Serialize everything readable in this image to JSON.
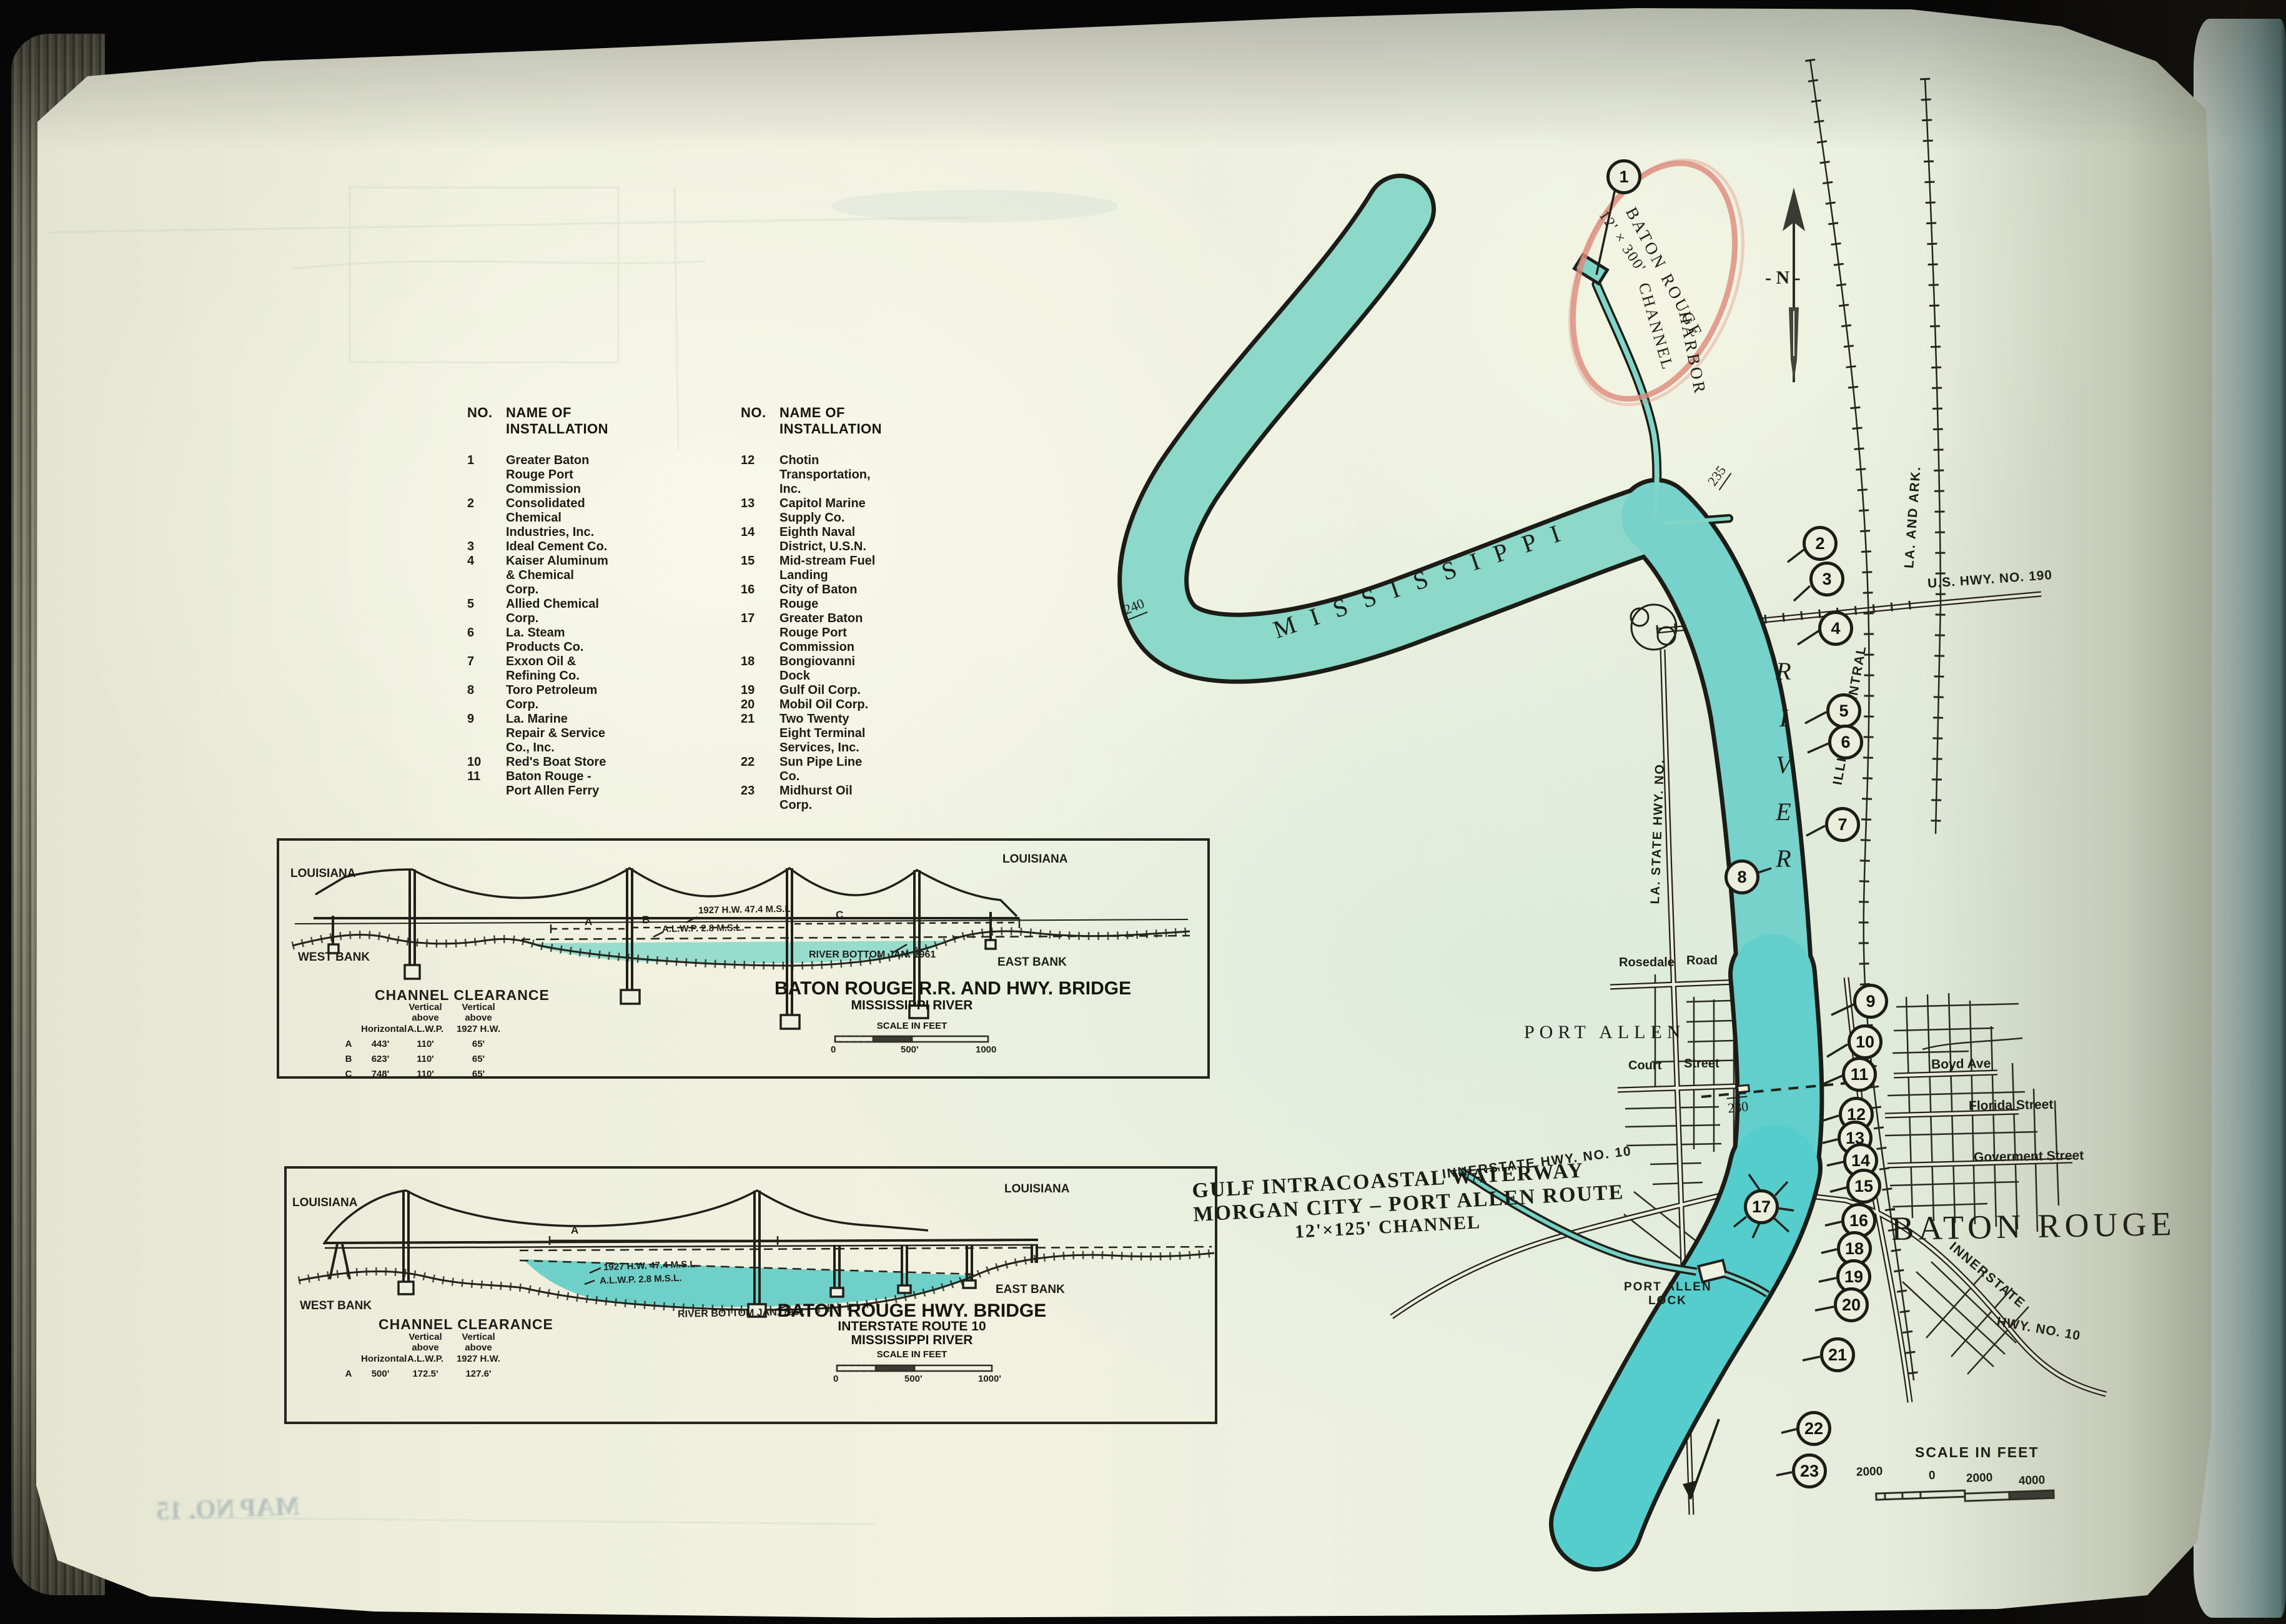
{
  "list": {
    "h_no": "NO.",
    "h_name": "NAME OF INSTALLATION",
    "items": [
      {
        "no": "1",
        "name": "Greater Baton Rouge Port Commission"
      },
      {
        "no": "2",
        "name": "Consolidated Chemical Industries, Inc."
      },
      {
        "no": "3",
        "name": "Ideal Cement Co."
      },
      {
        "no": "4",
        "name": "Kaiser Aluminum & Chemical Corp."
      },
      {
        "no": "5",
        "name": "Allied Chemical Corp."
      },
      {
        "no": "6",
        "name": "La. Steam Products Co."
      },
      {
        "no": "7",
        "name": "Exxon Oil & Refining Co."
      },
      {
        "no": "8",
        "name": "Toro Petroleum Corp."
      },
      {
        "no": "9",
        "name": "La. Marine Repair & Service Co., Inc."
      },
      {
        "no": "10",
        "name": "Red's Boat Store"
      },
      {
        "no": "11",
        "name": "Baton Rouge - Port Allen Ferry"
      },
      {
        "no": "12",
        "name": "Chotin Transportation, Inc."
      },
      {
        "no": "13",
        "name": "Capitol Marine Supply Co."
      },
      {
        "no": "14",
        "name": "Eighth Naval District, U.S.N."
      },
      {
        "no": "15",
        "name": "Mid-stream Fuel Landing"
      },
      {
        "no": "16",
        "name": "City of Baton Rouge"
      },
      {
        "no": "17",
        "name": "Greater Baton Rouge Port Commission"
      },
      {
        "no": "18",
        "name": "Bongiovanni Dock"
      },
      {
        "no": "19",
        "name": "Gulf Oil Corp."
      },
      {
        "no": "20",
        "name": "Mobil Oil Corp."
      },
      {
        "no": "21",
        "name": "Two Twenty Eight Terminal Services, Inc."
      },
      {
        "no": "22",
        "name": "Sun Pipe Line Co."
      },
      {
        "no": "23",
        "name": "Midhurst Oil Corp."
      }
    ]
  },
  "map": {
    "harbor_name_1": "BATON ROUGE",
    "harbor_name_2": "HARBOR",
    "harbor_dim": "12' × 300'",
    "harbor_channel": "CHANNEL",
    "compass": "- N -",
    "mississippi": "MISSISSIPPI",
    "river": "RIVER",
    "mile_240": "240",
    "mile_235": "235",
    "mile_230": "230",
    "us_hwy_190": "U.S. HWY. NO. 190",
    "la_and_ark": "LA. AND ARK.",
    "illinois_central": "ILLINOIS CENTRAL",
    "la_state_hwy": "LA. STATE HWY. NO.",
    "rosedale": "Rosedale",
    "road": "Road",
    "court": "Court",
    "street": "Street",
    "port_allen": "PORT ALLEN",
    "boyd_ave": "Boyd  Ave",
    "florida_street": "Florida  Street",
    "goverment_street": "Goverment  Street",
    "baton_rouge": "BATON ROUGE",
    "innerstate_west": "INNERSTATE  HWY.  NO. 10",
    "innerstate_east_1": "INNERSTATE",
    "innerstate_east_2": "HWY. NO. 10",
    "gicw_1": "GULF INTRACOASTAL WATERWAY",
    "gicw_2": "MORGAN CITY  –  PORT ALLEN ROUTE",
    "gicw_3": "12'×125' CHANNEL",
    "lock_1": "PORT ALLEN",
    "lock_2": "LOCK",
    "scale_title": "SCALE IN FEET",
    "scale_2000a": "2000",
    "scale_0": "0",
    "scale_2000b": "2000",
    "scale_4000": "4000"
  },
  "d1": {
    "state_l": "LOUISIANA",
    "state_r": "LOUISIANA",
    "west_bank": "WEST BANK",
    "east_bank": "EAST BANK",
    "span_a": "A",
    "span_b": "B",
    "span_c": "C",
    "hw": "1927 H.W.  47.4 M.S.L.",
    "alwp": "A.L.W.P.  2.8 M.S.L.",
    "river_bottom": "RIVER BOTTOM JAN. 1961",
    "clearance": "CHANNEL CLEARANCE",
    "col_h": "Horizontal",
    "col_v1a": "Vertical",
    "col_v1b": "above A.L.W.P.",
    "col_v2a": "Vertical above",
    "col_v2b": "1927 H.W.",
    "rows": [
      {
        "id": "A",
        "h": "443'",
        "v": "110'",
        "vh": "65'"
      },
      {
        "id": "B",
        "h": "623'",
        "v": "110'",
        "vh": "65'"
      },
      {
        "id": "C",
        "h": "748'",
        "v": "110'",
        "vh": "65'"
      }
    ],
    "title1": "BATON ROUGE R.R. AND HWY. BRIDGE",
    "title2": "MISSISSIPPI RIVER",
    "scale_title": "SCALE IN FEET",
    "s0": "0",
    "s500": "500'",
    "s1000": "1000"
  },
  "d2": {
    "state_l": "LOUISIANA",
    "state_r": "LOUISIANA",
    "west_bank": "WEST BANK",
    "east_bank": "EAST BANK",
    "span_a": "A",
    "hw": "1927 H.W.  47.4 M.S.L.",
    "alwp": "A.L.W.P.  2.8 M.S.L.",
    "river_bottom": "RIVER BOTTOM JAN. 1961",
    "clearance": "CHANNEL CLEARANCE",
    "col_h": "Horizontal",
    "col_v1a": "Vertical",
    "col_v1b": "above A.L.W.P.",
    "col_v2a": "Vertical above",
    "col_v2b": "1927 H.W.",
    "rows": [
      {
        "id": "A",
        "h": "500'",
        "v": "172.5'",
        "vh": "127.6'"
      }
    ],
    "title1": "BATON ROUGE HWY. BRIDGE",
    "title2": "INTERSTATE ROUTE 10",
    "title3": "MISSISSIPPI RIVER",
    "scale_title": "SCALE IN FEET",
    "s0": "0",
    "s500": "500'",
    "s1000": "1000'"
  },
  "misc": {
    "map_no_bleed": "MAP NO. 15"
  }
}
